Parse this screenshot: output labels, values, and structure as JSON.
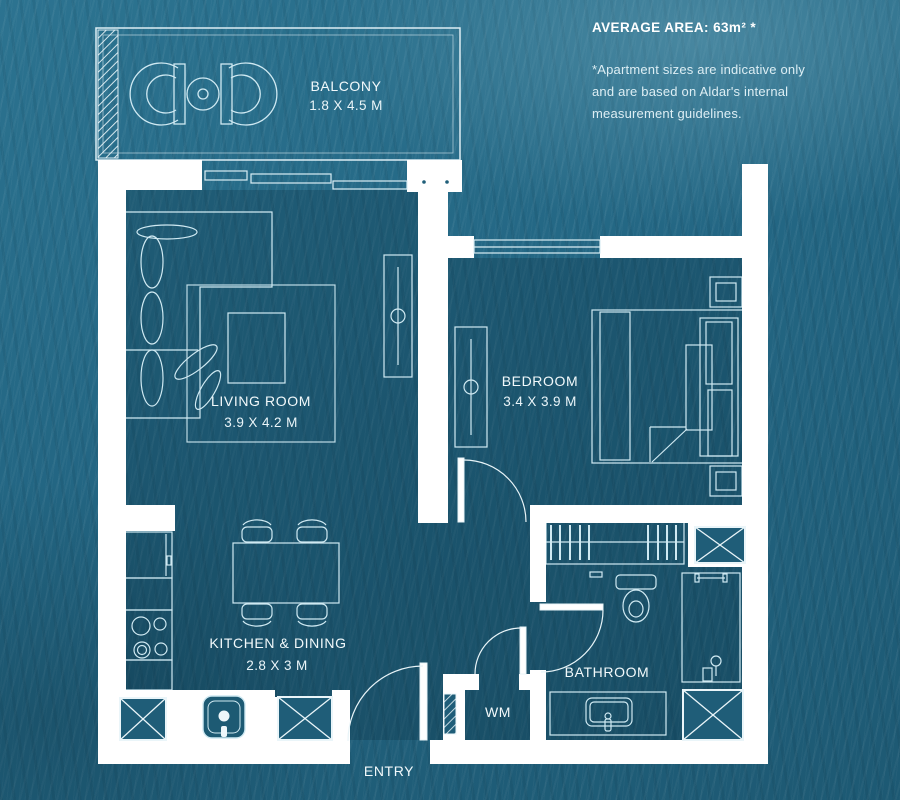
{
  "info_panel": {
    "title": "AVERAGE AREA: 63m² *",
    "disclaimer_lines": [
      "*Apartment sizes are indicative only",
      "and are based on Aldar's internal",
      "measurement guidelines."
    ]
  },
  "rooms": {
    "balcony": {
      "name": "BALCONY",
      "dimensions": "1.8 X 4.5 M"
    },
    "living_room": {
      "name": "LIVING ROOM",
      "dimensions": "3.9 X 4.2 M"
    },
    "bedroom": {
      "name": "BEDROOM",
      "dimensions": "3.4 X 3.9 M"
    },
    "kitchen_dining": {
      "name": "KITCHEN & DINING",
      "dimensions": "2.8 X 3 M"
    },
    "bathroom": {
      "name": "BATHROOM"
    },
    "wm": {
      "name": "WM"
    },
    "entry": {
      "name": "ENTRY"
    }
  },
  "colors": {
    "water": "#236683",
    "water_dark": "#1d5973",
    "wall": "#ffffff",
    "plan_line": "#cfe9f2",
    "interior_shade": "rgba(4,30,44,0.22)",
    "text": "#ffffff"
  }
}
